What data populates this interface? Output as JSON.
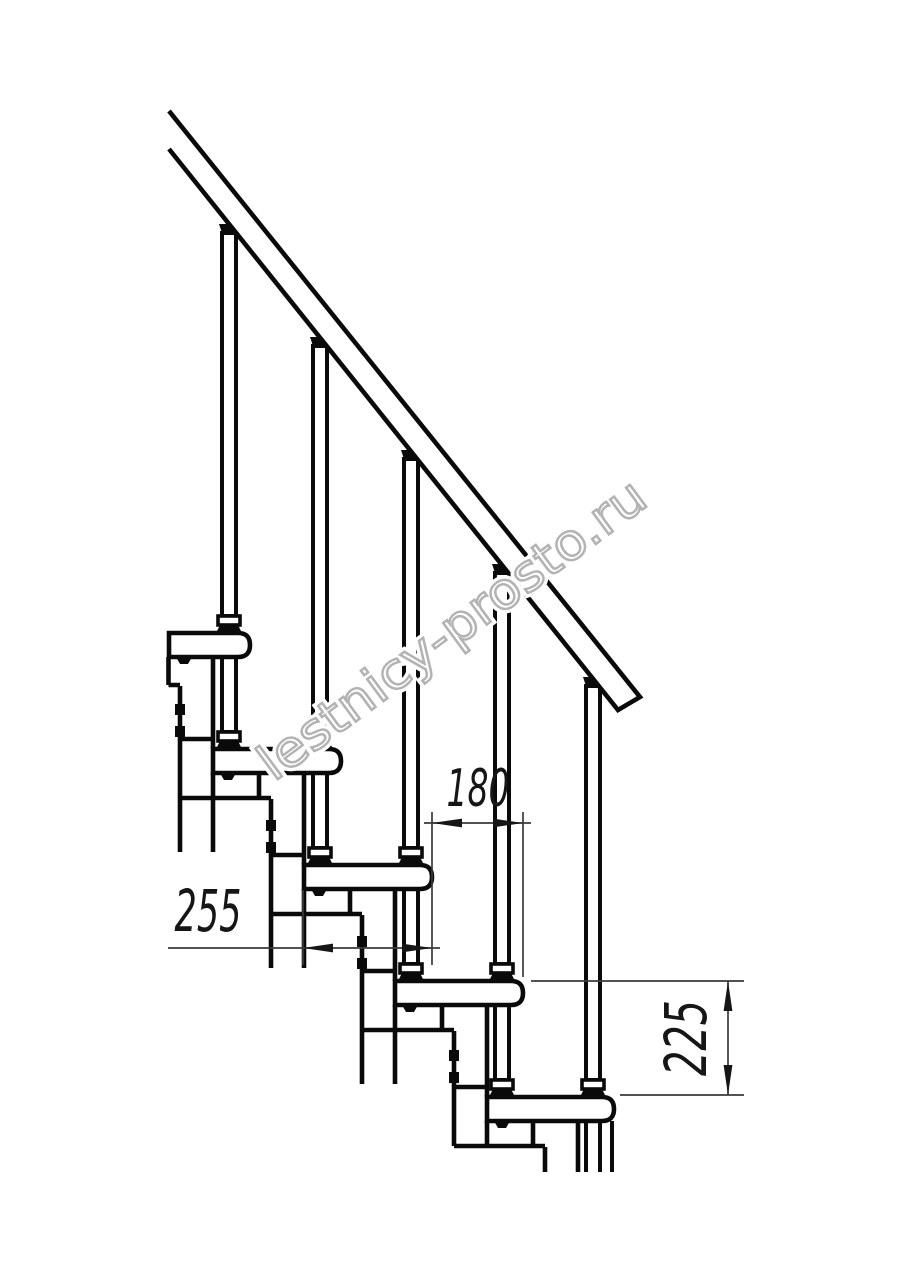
{
  "drawing": {
    "background": "#ffffff",
    "line_color": "#0a0a0a",
    "dimension_color": "#3a3a3a",
    "dimensions": {
      "tread_depth": {
        "label": "255"
      },
      "step_run": {
        "label": "180"
      },
      "step_rise": {
        "label": "225"
      }
    },
    "watermark": {
      "text": "lestnicy-prosto.ru",
      "color": "#b3b3b3"
    }
  }
}
